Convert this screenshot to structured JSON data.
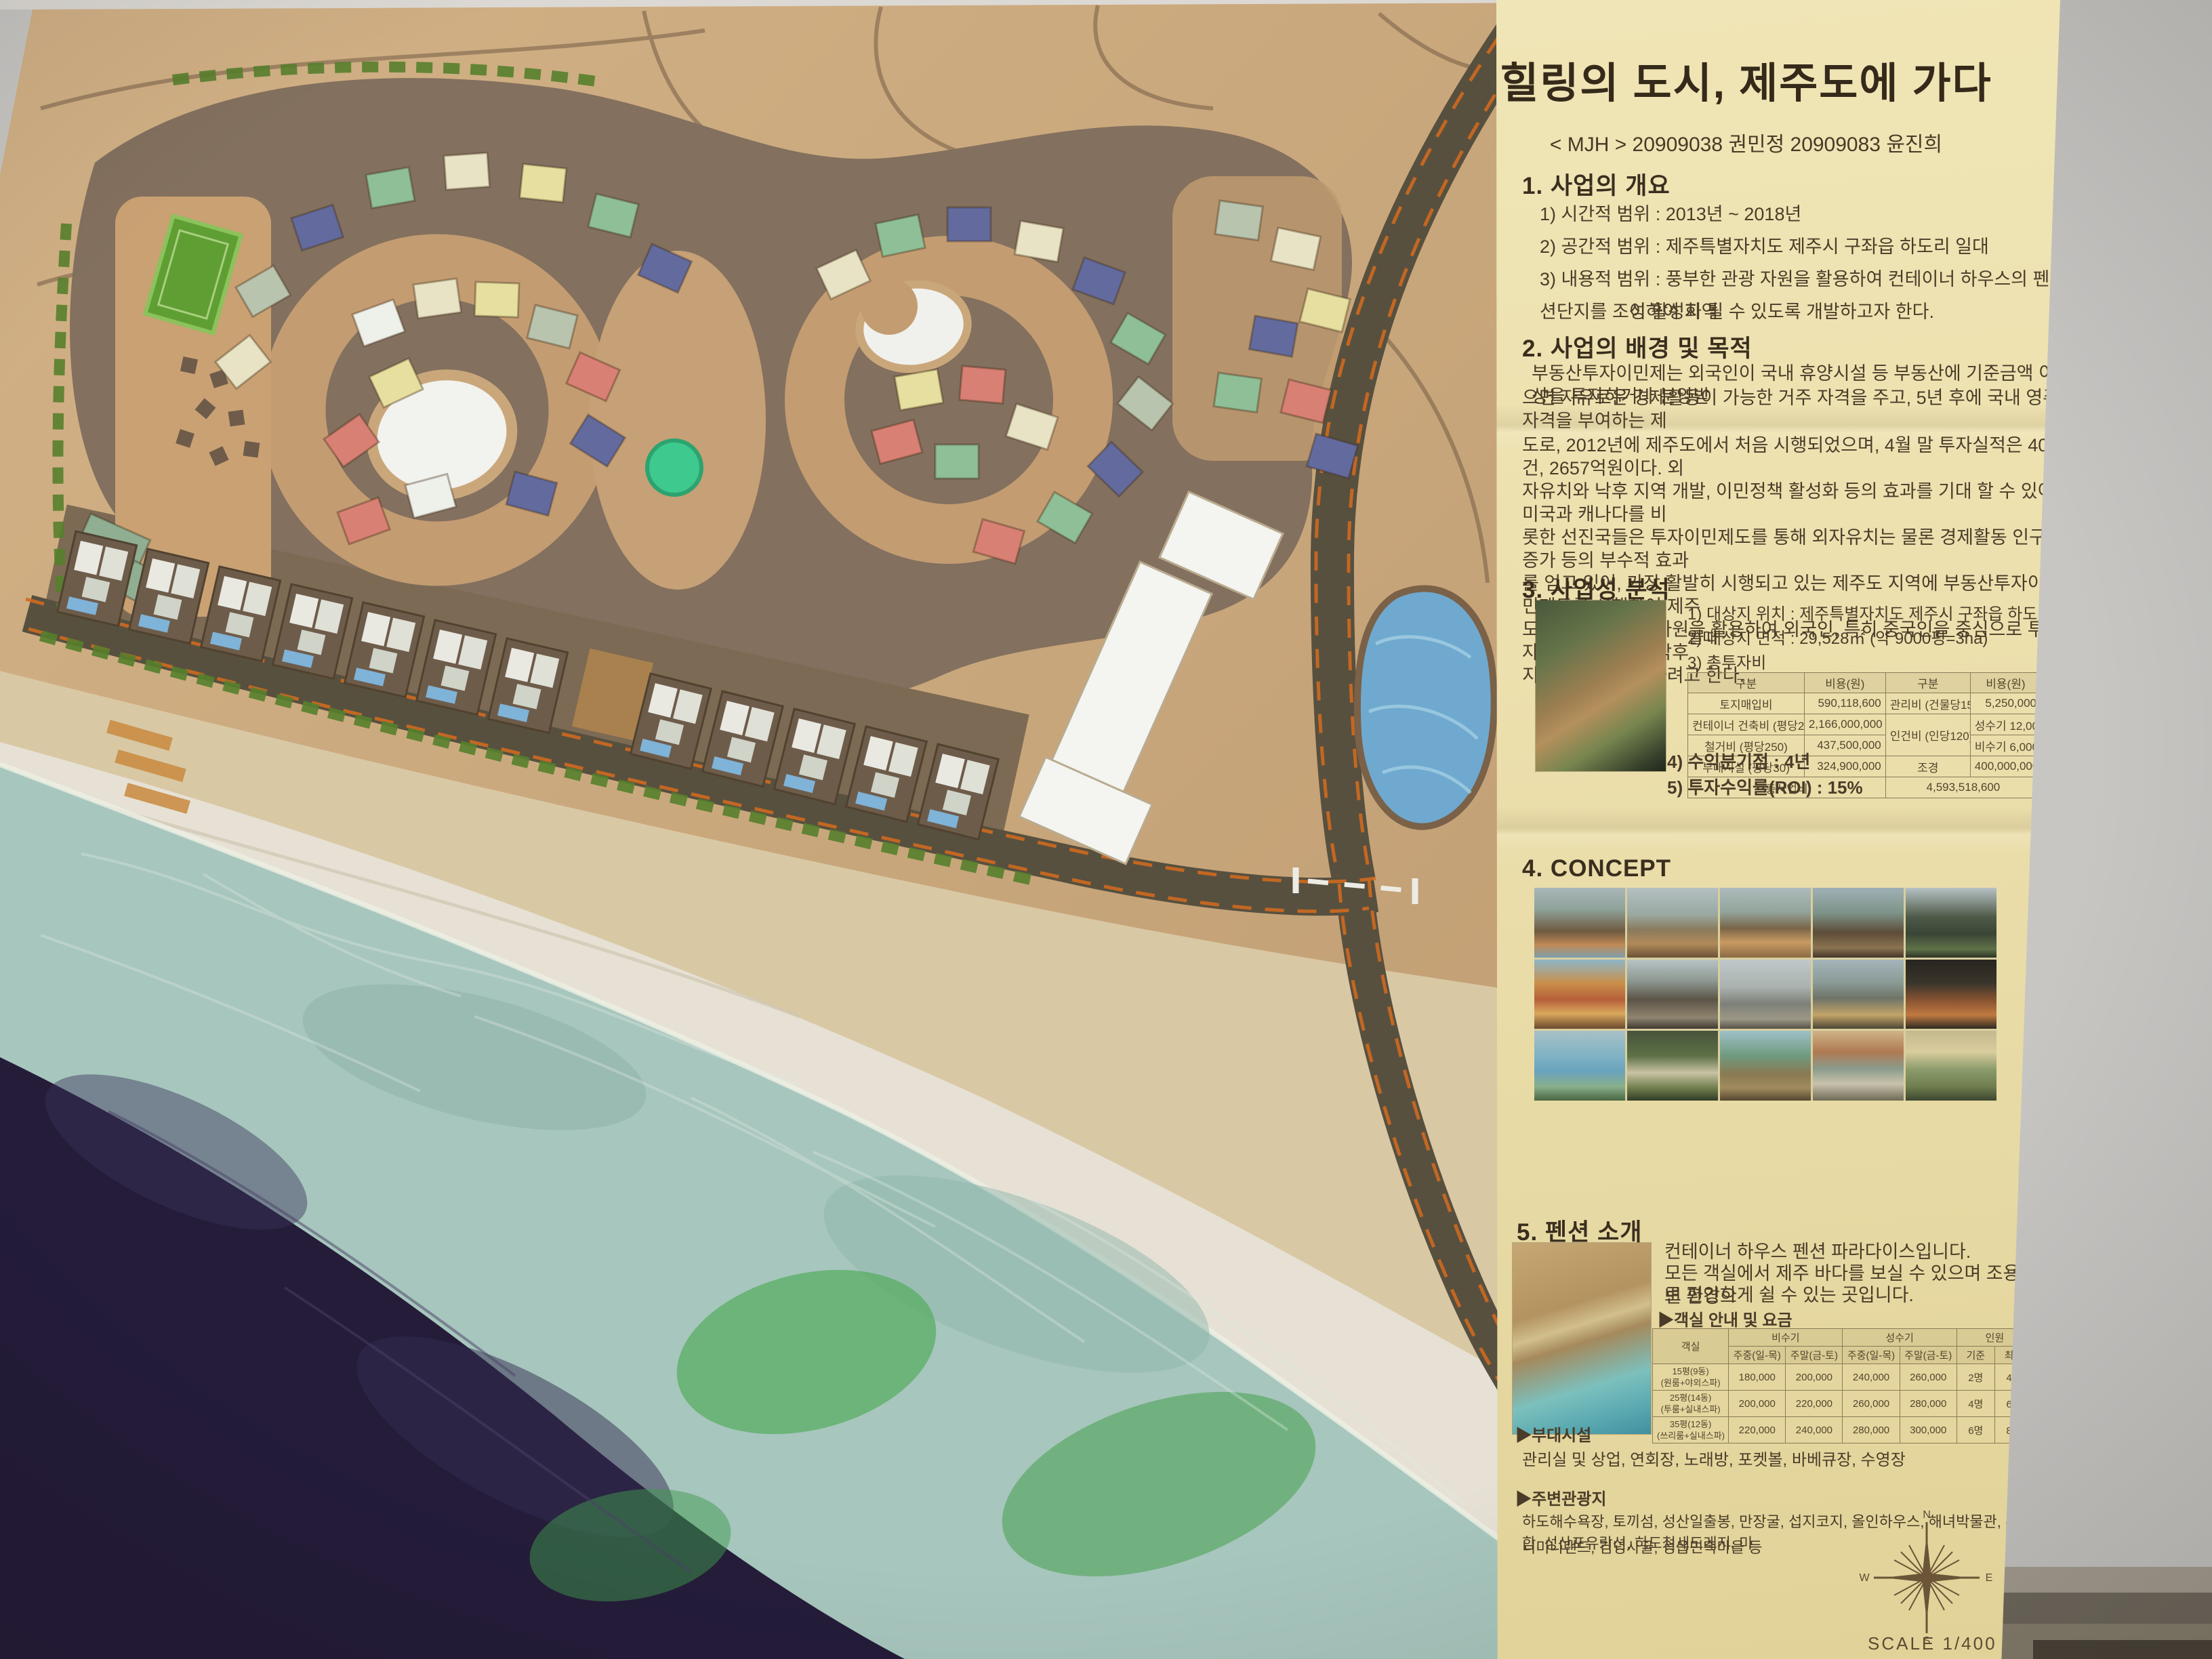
{
  "colors": {
    "panel_bg": "#ece0ae",
    "board_tan": "#c9a87e",
    "site_taupe": "#84705f",
    "road": "#57503f",
    "road_stripe_orange": "#cf6a1f",
    "sea_foam": "#a7c6bd",
    "deep_sea": "#241c39",
    "pond_blue": "#6fa9cf",
    "field_green": "#619f33",
    "house_navy": "#636a9e",
    "house_green": "#8fbf96",
    "house_cream": "#e7e3c4",
    "house_yellow": "#e7df9f",
    "house_salmon": "#d88073",
    "house_white": "#eef0ea"
  },
  "model": {
    "compass": {
      "n": "N",
      "e": "E",
      "s": "S",
      "w": "W"
    },
    "scale_label": "SCALE 1/400"
  },
  "panel": {
    "title": "힐링의 도시, 제주도에 가다",
    "byline": "< MJH > 20909038 권민정 20909083 윤진희",
    "sec1": {
      "heading": "1. 사업의 개요",
      "items": [
        "1) 시간적 범위 : 2013년 ~ 2018년",
        "2) 공간적 범위 : 제주특별자치도 제주시 구좌읍 하도리 일대",
        "3) 내용적 범위 : 풍부한 관광 자원을 활용하여 컨테이너 하우스의 펜션단지를 조성하여 지역",
        "이 활성화 될 수 있도록 개발하고자 한다."
      ]
    },
    "sec2": {
      "heading": "2. 사업의 배경 및 목적",
      "lines": [
        "부동산투자이민제는 외국인이 국내 휴양시설 등 부동산에 기준금액 이상을 투자하거나 분양받",
        "으면 자유로운 경제활동이 가능한 거주 자격을 주고, 5년 후에 국내 영주 자격을 부여하는 제"
      ],
      "para2": [
        "도로, 2012년에 제주도에서 처음 시행되었으며, 4월 말 투자실적은 409건, 2657억원이다. 외",
        "자유치와 낙후 지역 개발, 이민정책 활성화 등의 효과를 기대 할 수 있어 미국과 캐나다를 비",
        "롯한 선진국들은 투자이민제도를 통해 외자유치는 물론 경제활동 인구 증가 등의 부수적 효과",
        "를 얻고 있어, 가장 활발히 시행되고 있는 제주도 지역에 부동산투자이민제도를 시행하여 제주",
        "도의 천혜의 관광 자원을 활용하여 외국인, 특히 중국인을 중심으로 투자를 활성화시켜, 낙후",
        "지역 개발을 추진하려고 한다."
      ]
    },
    "sec3": {
      "heading": "3. 사업성 분석",
      "items": [
        "1) 대상지 위치 : 제주특별자치도 제주시 구좌읍 하도리 일대",
        "2) 대상지 면적 : 29,528㎡ (약 9000평=3ha)",
        "3) 총투자비"
      ],
      "cost_table": {
        "headers": [
          "구분",
          "비용(원)",
          "구분",
          "비용(원)"
        ],
        "rows": [
          [
            "토지매입비",
            "590,118,600",
            "관리비 (건물당15)",
            "5,250,000"
          ],
          [
            "컨테이너 건축비 (평당200)",
            "2,166,000,000",
            "인건비 (인당120)",
            "성수기 12,000,000"
          ],
          [
            "철거비 (평당250)",
            "437,500,000",
            "",
            "비수기 6,000,000"
          ],
          [
            "부대시설 (평당30)",
            "324,900,000",
            "조경",
            "400,000,000"
          ]
        ],
        "total_label": "총사업비",
        "total_value": "4,593,518,600"
      },
      "notes": [
        "4) 수익분기점 : 4년",
        "5) 투자수익률(ROI) : 15%"
      ]
    },
    "sec4": {
      "heading": "4. CONCEPT"
    },
    "sec5": {
      "heading": "5. 펜션 소개",
      "intro": [
        "컨테이너 하우스 펜션 파라다이스입니다.",
        "모든 객실에서 제주 바다를 보실 수 있으며 조용한 주변 환경으",
        "로 편안하게 쉴 수 있는 곳입니다."
      ],
      "price_caption": "▶객실 안내 및 요금",
      "price_table": {
        "col_groups": [
          "객실",
          "비수기",
          "성수기",
          "인원"
        ],
        "sub_headers": [
          "주중(일-목)",
          "주말(금-토)",
          "주중(일-목)",
          "주말(금-토)",
          "기준",
          "최대"
        ],
        "rows": [
          {
            "room": "15평(9동)",
            "desc": "(원룸+야외스파)",
            "cells": [
              "180,000",
              "200,000",
              "240,000",
              "260,000",
              "2명",
              "4명"
            ]
          },
          {
            "room": "25평(14동)",
            "desc": "(투룸+실내스파)",
            "cells": [
              "200,000",
              "220,000",
              "260,000",
              "280,000",
              "4명",
              "6명"
            ]
          },
          {
            "room": "35평(12동)",
            "desc": "(쓰리룸+실내스파)",
            "cells": [
              "220,000",
              "240,000",
              "280,000",
              "300,000",
              "6명",
              "8명"
            ]
          }
        ]
      },
      "facilities_heading": "▶부대시설",
      "facilities": "관리실 및 상업, 연회장, 노래방, 포켓볼, 바베큐장, 수영장",
      "attractions_heading": "▶주변관광지",
      "attractions": [
        "하도해수욕장, 토끼섬, 성산일출봉, 만장굴, 섭지코지, 올인하우스, 해녀박물관, 우도잠수함, 성산포유람선, 하도철새도래지, 미",
        "니미니랜드, 김녕사굴, 성읍민속마을 등"
      ]
    }
  }
}
